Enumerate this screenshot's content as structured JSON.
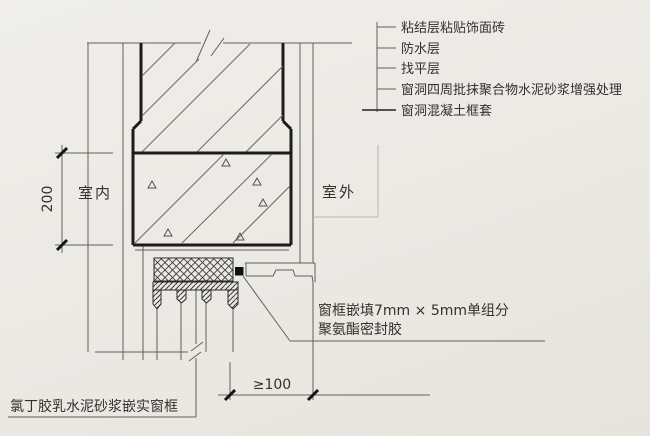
{
  "diagram": {
    "type": "architectural-section-detail",
    "interior_label": "室内",
    "exterior_label": "室外",
    "dimensions": {
      "vertical": "200",
      "horizontal": "≥100"
    },
    "callouts_right": [
      "粘结层粘贴饰面砖",
      "防水层",
      "找平层",
      "窗洞四周批抹聚合物水泥砂浆增强处理",
      "窗洞混凝土框套"
    ],
    "callout_sealant": {
      "line1": "窗框嵌填7mm × 5mm单组分",
      "line2": "聚氨酯密封胶"
    },
    "callout_bottom": "氯丁胶乳水泥砂浆嵌实窗框",
    "colors": {
      "paper": "#ebe9e4",
      "thin_line": "#62605a",
      "heavy_line": "#1d1c1a",
      "text": "#33312c",
      "sealant_fill": "#111110"
    }
  }
}
